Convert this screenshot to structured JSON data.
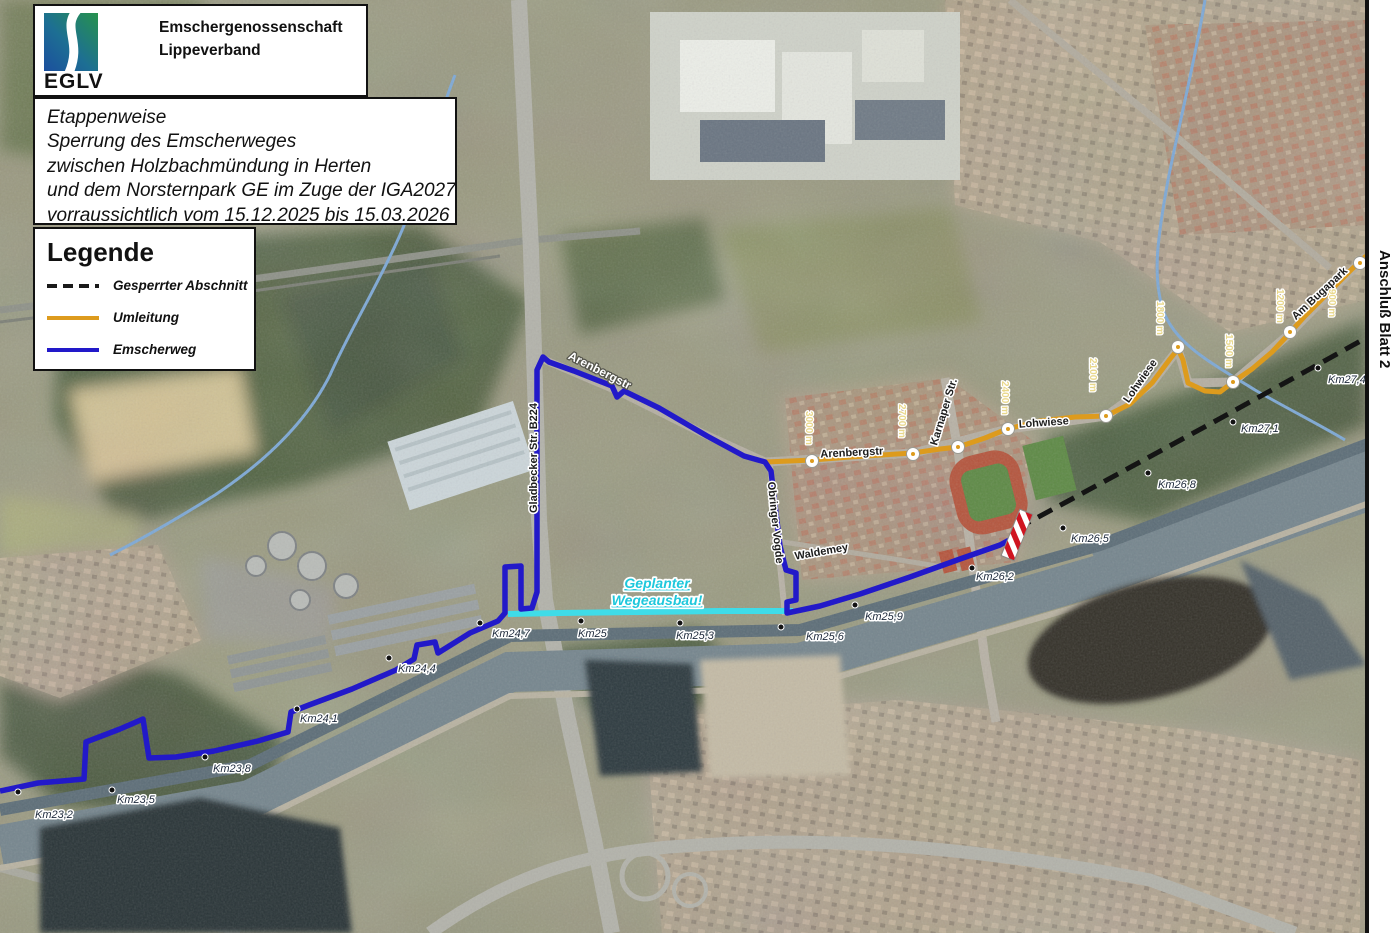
{
  "branding": {
    "org_line1": "Emschergenossenschaft",
    "org_line2": "Lippeverband",
    "logo_text": "EGLV"
  },
  "title_box": {
    "lines": [
      "Etappenweise",
      "Sperrung des Emscherweges",
      "zwischen Holzbachmündung in Herten",
      "und dem Norsternpark GE im Zuge der IGA2027",
      "vorraussichtlich vom 15.12.2025 bis 15.03.2026"
    ]
  },
  "legend": {
    "heading": "Legende",
    "items": [
      {
        "label": "Gesperrter Abschnitt",
        "style": "dashed",
        "color": "#1a1a1a"
      },
      {
        "label": "Umleitung",
        "style": "solid",
        "color": "#dd9b1d"
      },
      {
        "label": "Emscherweg",
        "style": "solid",
        "color": "#2219c9"
      }
    ]
  },
  "map": {
    "sheet_link_label": "Anschluß Blatt 2",
    "planned_work_label": {
      "line1": "Geplanter",
      "line2": "Wegeausbau!"
    },
    "colors": {
      "emscherweg": "#2219c9",
      "umleitung": "#dd9b1d",
      "gesperrter_abschnitt": "#141414",
      "wegeausbau": "#3fdce8",
      "barrier_red": "#cf1420",
      "barrier_white": "#ffffff"
    },
    "km_markers": [
      {
        "label": "Km23,2",
        "x": 35,
        "y": 818,
        "dot": [
          18,
          792
        ]
      },
      {
        "label": "Km23,5",
        "x": 117,
        "y": 803,
        "dot": [
          112,
          790
        ]
      },
      {
        "label": "Km23,8",
        "x": 213,
        "y": 772,
        "dot": [
          205,
          757
        ]
      },
      {
        "label": "Km24,1",
        "x": 300,
        "y": 722,
        "dot": [
          297,
          709
        ]
      },
      {
        "label": "Km24,4",
        "x": 398,
        "y": 672,
        "dot": [
          389,
          658
        ]
      },
      {
        "label": "Km24,7",
        "x": 492,
        "y": 637,
        "dot": [
          480,
          623
        ]
      },
      {
        "label": "Km25",
        "x": 578,
        "y": 637,
        "dot": [
          581,
          621
        ]
      },
      {
        "label": "Km25,3",
        "x": 676,
        "y": 639,
        "dot": [
          680,
          623
        ]
      },
      {
        "label": "Km25,6",
        "x": 806,
        "y": 640,
        "dot": [
          781,
          627
        ]
      },
      {
        "label": "Km25,9",
        "x": 865,
        "y": 620,
        "dot": [
          855,
          605
        ]
      },
      {
        "label": "Km26,2",
        "x": 976,
        "y": 580,
        "dot": [
          972,
          568
        ]
      },
      {
        "label": "Km26,5",
        "x": 1071,
        "y": 542,
        "dot": [
          1063,
          528
        ]
      },
      {
        "label": "Km26,8",
        "x": 1158,
        "y": 488,
        "dot": [
          1148,
          473
        ]
      },
      {
        "label": "Km27,1",
        "x": 1241,
        "y": 432,
        "dot": [
          1233,
          422
        ]
      },
      {
        "label": "Km27,4",
        "x": 1328,
        "y": 383,
        "dot": [
          1318,
          368
        ]
      }
    ],
    "distance_markers": [
      {
        "label": "3000 m",
        "cx": 812,
        "cy": 461,
        "lx": 806,
        "ly": 428
      },
      {
        "label": "2700 m",
        "cx": 913,
        "cy": 454,
        "lx": 899,
        "ly": 421
      },
      {
        "label": "2400 m",
        "cx": 1008,
        "cy": 429,
        "lx": 1002,
        "ly": 398
      },
      {
        "label": "2100 m",
        "cx": 1106,
        "cy": 416,
        "lx": 1090,
        "ly": 375
      },
      {
        "label": "1800 m",
        "cx": 1178,
        "cy": 347,
        "lx": 1157,
        "ly": 318
      },
      {
        "label": "1500 m",
        "cx": 1233,
        "cy": 382,
        "lx": 1226,
        "ly": 351
      },
      {
        "label": "1200 m",
        "cx": 1290,
        "cy": 332,
        "lx": 1277,
        "ly": 306
      },
      {
        "label": "900 m",
        "cx": 1360,
        "cy": 263,
        "lx": 1329,
        "ly": 303
      }
    ],
    "plain_waypoints": [
      {
        "cx": 958,
        "cy": 447
      }
    ],
    "street_labels": [
      {
        "label": "Gladbecker Str.  B224",
        "x": 537,
        "y": 458,
        "rot": -90,
        "light": false
      },
      {
        "label": "Arenbergstr",
        "x": 598,
        "y": 374,
        "rot": 27,
        "light": true
      },
      {
        "label": "Arenbergstr",
        "x": 852,
        "y": 456,
        "rot": -3,
        "light": false
      },
      {
        "label": "Karnaper Str.",
        "x": 947,
        "y": 413,
        "rot": -73,
        "light": false
      },
      {
        "label": "Lohwiese",
        "x": 1044,
        "y": 426,
        "rot": -4,
        "light": false
      },
      {
        "label": "Lohwiese",
        "x": 1143,
        "y": 383,
        "rot": -55,
        "light": false
      },
      {
        "label": "Waldemey",
        "x": 822,
        "y": 555,
        "rot": -10,
        "light": false
      },
      {
        "label": "Obringer Vogde",
        "x": 772,
        "y": 523,
        "rot": 84,
        "light": false
      },
      {
        "label": "Am Bugapark",
        "x": 1322,
        "y": 296,
        "rot": -43,
        "light": false
      }
    ]
  }
}
